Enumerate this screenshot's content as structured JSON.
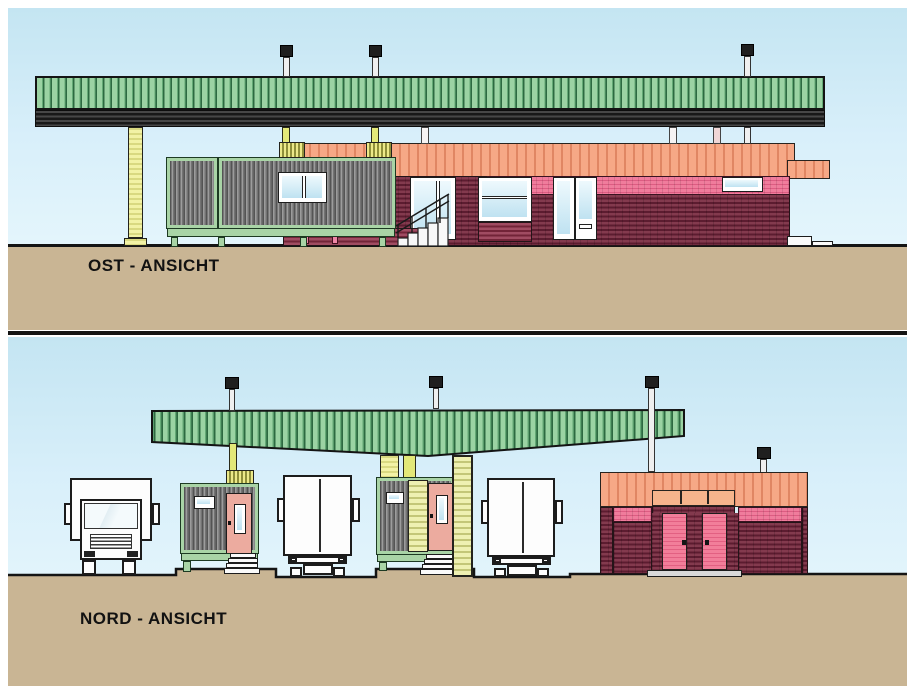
{
  "panels": [
    {
      "id": "ost",
      "label": "OST - ANSICHT"
    },
    {
      "id": "nord",
      "label": "NORD - ANSICHT"
    }
  ],
  "palette": {
    "sky_top": "#c4e5f2",
    "sky_bottom": "#edfafd",
    "ground": "#c9b594",
    "canopy_green": "#9bd3a3",
    "canopy_stripe": "#2d6a41",
    "canopy_beam": "#2a2a2a",
    "column_yellow": "#f2f2a6",
    "container_gray": "#7a7a7a",
    "container_frame": "#a9d4a6",
    "roof_salmon": "#f29e7c",
    "band_pink": "#ec6f92",
    "wall_maroon": "#6f2537",
    "door_pink": "#eba89e",
    "glass_blue": "#bfe2f1",
    "truck_white": "#fdfdfd",
    "outline": "#141414"
  }
}
